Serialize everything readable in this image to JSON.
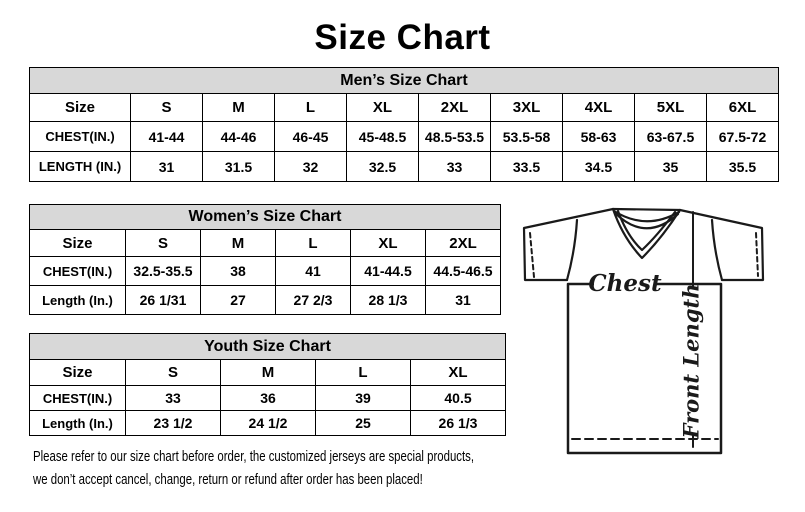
{
  "page_title": "Size Chart",
  "tables": [
    {
      "id": "mens",
      "title": "Men’s Size Chart",
      "columns": [
        "Size",
        "S",
        "M",
        "L",
        "XL",
        "2XL",
        "3XL",
        "4XL",
        "5XL",
        "6XL"
      ],
      "rows": [
        {
          "label": "CHEST(IN.)",
          "values": [
            "41-44",
            "44-46",
            "46-45",
            "45-48.5",
            "48.5-53.5",
            "53.5-58",
            "58-63",
            "63-67.5",
            "67.5-72"
          ]
        },
        {
          "label": "LENGTH (IN.)",
          "values": [
            "31",
            "31.5",
            "32",
            "32.5",
            "33",
            "33.5",
            "34.5",
            "35",
            "35.5"
          ]
        }
      ]
    },
    {
      "id": "womens",
      "title": "Women’s Size Chart",
      "columns": [
        "Size",
        "S",
        "M",
        "L",
        "XL",
        "2XL"
      ],
      "rows": [
        {
          "label": "CHEST(IN.)",
          "values": [
            "32.5-35.5",
            "38",
            "41",
            "41-44.5",
            "44.5-46.5"
          ]
        },
        {
          "label": "Length (In.)",
          "values": [
            "26 1/31",
            "27",
            "27 2/3",
            "28 1/3",
            "31"
          ]
        }
      ]
    },
    {
      "id": "youth",
      "title": "Youth Size Chart",
      "columns": [
        "Size",
        "S",
        "M",
        "L",
        "XL"
      ],
      "rows": [
        {
          "label": "CHEST(IN.)",
          "values": [
            "33",
            "36",
            "39",
            "40.5"
          ]
        },
        {
          "label": "Length (In.)",
          "values": [
            "23 1/2",
            "24 1/2",
            "25",
            "26 1/3"
          ]
        }
      ]
    }
  ],
  "diagram": {
    "chest_label": "Chest",
    "front_length_label": "Front Length"
  },
  "disclaimer": {
    "lines": [
      "Please refer to our size chart before order, the customized jerseys are special products,",
      "we don’t accept cancel, change, return or refund after order has been placed!"
    ]
  },
  "colors": {
    "table_header_bg": "#d8d8d8",
    "border": "#000000",
    "text": "#000000",
    "background": "#ffffff"
  }
}
